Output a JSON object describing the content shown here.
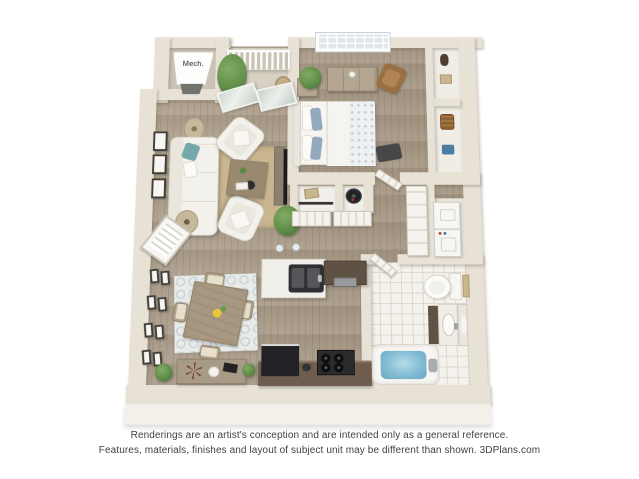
{
  "canvas": {
    "width": 639,
    "height": 479,
    "background": "#ffffff"
  },
  "plan": {
    "type": "3d-apartment-floorplan",
    "labels": {
      "mech": "Mech."
    },
    "rooms": [
      "balcony",
      "mechanical-closet",
      "living-room",
      "dining-area",
      "kitchen",
      "bedroom",
      "bedroom-closet",
      "storage-closets",
      "hallway",
      "laundry-closet",
      "bathroom"
    ],
    "colors": {
      "wall": "#e7e2d5",
      "wallEdge": "#cbc4b4",
      "wallFace": "#f3f0e9",
      "wood": "#a2937f",
      "woodLight": "#b0a28f",
      "balconyFloor": "#d7d0c3",
      "mechFloor": "#cbc4b6",
      "tile": "#f4f2ed",
      "tileLine": "#dcd7cc",
      "closetFloor": "#efede6",
      "rugLiving": "#c9b691",
      "rugDining": "#e9ebe9",
      "sofa": "#f3f1eb",
      "tealPillow": "#74a8ab",
      "bluePillow": "#93a9bd",
      "woodFurniture": "#a89882",
      "darkCabinet": "#5f5244",
      "counter": "#6e5d4e",
      "appliance": "#2a2a2c",
      "water": "#7fb9d2",
      "plant": "#5d8a46",
      "accentRust": "#7c3b2b"
    }
  },
  "disclaimer": {
    "line1": "Renderings are an artist's conception and are intended only as a general reference.",
    "line2": "Features, materials, finishes and layout of subject unit may be different than shown. 3DPlans.com"
  }
}
